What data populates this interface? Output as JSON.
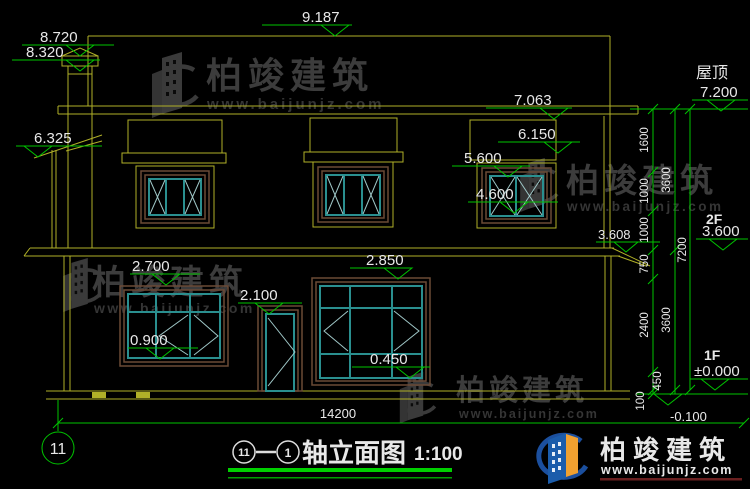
{
  "drawing": {
    "axis_bubble_label": "11",
    "title_axis_start": "11",
    "title_axis_end": "1",
    "title_text": "轴立面图",
    "title_scale": "1:100"
  },
  "levels": {
    "ridge": "9.187",
    "chimney_top": "8.720",
    "chimney_cap": "8.320",
    "roof_label": "屋顶",
    "roof": "7.200",
    "dormer_top": "7.063",
    "left_eave": "6.325",
    "dormer_mid": "6.150",
    "win2f_top": "5.600",
    "win2f_bottom": "4.600",
    "eave_right": "3.608",
    "f2_label": "2F",
    "f2": "3.600",
    "win1f_left_top": "2.700",
    "win1f_main_top": "2.850",
    "door_top": "2.100",
    "win1f_left_bottom": "0.900",
    "win1f_main_bottom": "0.450",
    "f1_label": "1F",
    "f1": "±0.000",
    "ground": "-0.100"
  },
  "dimensions": {
    "total_width": "14200",
    "right_chain_inner": [
      "1600",
      "1000",
      "1000",
      "750",
      "2400",
      "450",
      "100"
    ],
    "right_chain_mid": [
      "3600",
      "3600"
    ],
    "right_chain_outer": "7200"
  },
  "watermark": {
    "name": "柏竣建筑",
    "site": "www.baijunjz.com"
  },
  "logo": {
    "name": "柏竣建筑",
    "site": "www.baijunjz.com"
  },
  "colors": {
    "line_yellow": "#b0b028",
    "dim_green": "#00c300",
    "window_teal": "#2a8f8f",
    "frame_brown": "#6b4a36",
    "logo_blue": "#1b4f9e",
    "logo_orange": "#f0a030"
  }
}
